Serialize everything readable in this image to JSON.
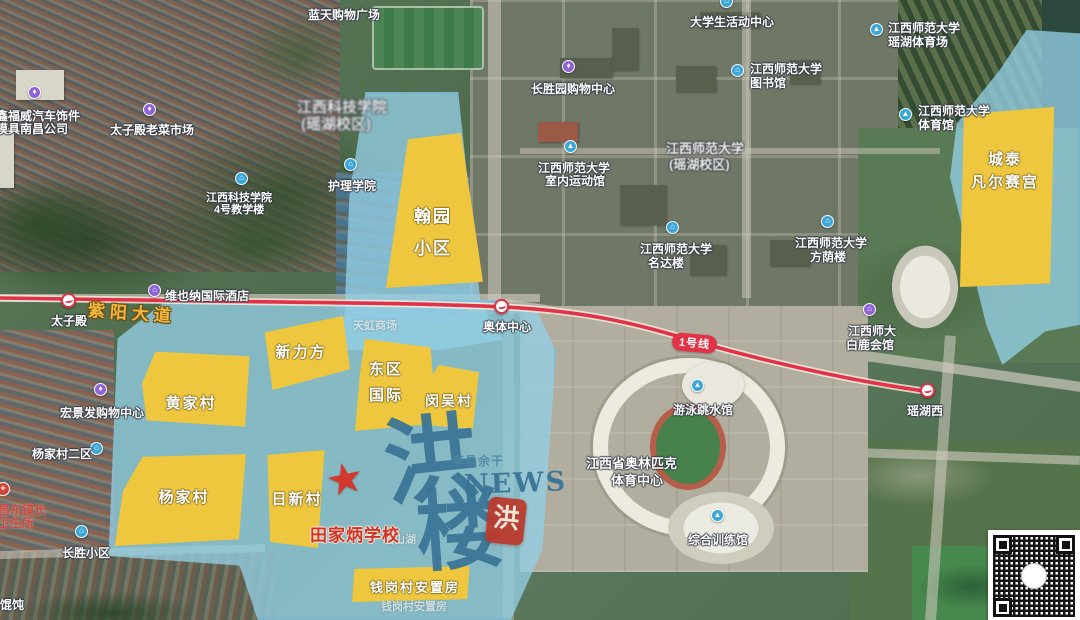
{
  "map": {
    "road_name": "紫阳大道"
  },
  "metro": {
    "line_badge": "1号线",
    "line_color": "#e23248",
    "stations": [
      {
        "id": "taizidian",
        "label": "太子殿"
      },
      {
        "id": "aoti",
        "label": "奥体中心"
      },
      {
        "id": "yaohuxi",
        "label": "瑶湖西"
      }
    ]
  },
  "zones": [
    {
      "id": "hanyuan",
      "lines": [
        "翰园",
        "小区"
      ]
    },
    {
      "id": "xinlifang",
      "lines": [
        "新力方"
      ]
    },
    {
      "id": "dongqu",
      "lines": [
        "东区",
        "国际"
      ]
    },
    {
      "id": "minwu",
      "lines": [
        "闵吴村"
      ]
    },
    {
      "id": "huangjia",
      "lines": [
        "黄家村"
      ]
    },
    {
      "id": "yangjia",
      "lines": [
        "杨家村"
      ]
    },
    {
      "id": "rixin",
      "lines": [
        "日新村"
      ]
    },
    {
      "id": "chengtai",
      "lines": [
        "城泰",
        "凡尔赛宫"
      ]
    },
    {
      "id": "qiangang",
      "lines": [
        "钱岗村安置房"
      ]
    }
  ],
  "pois": [
    {
      "id": "lantian",
      "lines": [
        "蓝天购物广场"
      ],
      "icon": null
    },
    {
      "id": "daxuesheng",
      "lines": [
        "大学生活动中心"
      ],
      "icon": "activity-center-icon",
      "icon_color": "#3ba6d8",
      "glyph": "⌂"
    },
    {
      "id": "yaohu_tiyuchang",
      "lines": [
        "江西师范大学",
        "瑶湖体育场"
      ],
      "icon": "stadium-icon",
      "icon_color": "#3ba6d8",
      "glyph": "▲"
    },
    {
      "id": "tushuguan",
      "lines": [
        "江西师范大学",
        "图书馆"
      ],
      "icon": "library-icon",
      "icon_color": "#3ba6d8",
      "glyph": "⌂"
    },
    {
      "id": "shifan_tiyuguan",
      "lines": [
        "江西师范大学",
        "体育馆"
      ],
      "icon": "gym-icon",
      "icon_color": "#3ba6d8",
      "glyph": "▲"
    },
    {
      "id": "keji_campus",
      "lines": [
        "江西科技学院",
        "(瑶湖校区)"
      ],
      "icon": null
    },
    {
      "id": "shifan_campus",
      "lines": [
        "江西师范大学",
        "(瑶湖校区)"
      ],
      "icon": null
    },
    {
      "id": "changshengyuan",
      "lines": [
        "长胜园购物中心"
      ],
      "icon": "shopping-icon",
      "icon_color": "#8f62d8",
      "glyph": "♦"
    },
    {
      "id": "shinei",
      "lines": [
        "江西师范大学",
        "室内运动馆"
      ],
      "icon": "gym-icon",
      "icon_color": "#3ba6d8",
      "glyph": "▲"
    },
    {
      "id": "huli",
      "lines": [
        "护理学院"
      ],
      "icon": "school-icon",
      "icon_color": "#3ba6d8",
      "glyph": "⌂"
    },
    {
      "id": "keji4",
      "lines": [
        "江西科技学院",
        "4号教学楼"
      ],
      "icon": "school-icon",
      "icon_color": "#3ba6d8",
      "glyph": "⌂"
    },
    {
      "id": "weiyena",
      "lines": [
        "维也纳国际酒店"
      ],
      "icon": "hotel-icon",
      "icon_color": "#8f62d8",
      "glyph": "⌂"
    },
    {
      "id": "taizimarket",
      "lines": [
        "太子殿老菜市场"
      ],
      "icon": "market-icon",
      "icon_color": "#8f62d8",
      "glyph": "♦"
    },
    {
      "id": "xinfuwei",
      "lines": [
        "鑫福威汽车饰件",
        "模具南昌公司"
      ],
      "icon": "shop-icon",
      "icon_color": "#8f62d8",
      "glyph": "♦"
    },
    {
      "id": "hongjingfa",
      "lines": [
        "宏景发购物中心"
      ],
      "icon": "shopping-icon",
      "icon_color": "#8f62d8",
      "glyph": "♦"
    },
    {
      "id": "yangjia2",
      "lines": [
        "杨家村二区"
      ],
      "icon": "residence-icon",
      "icon_color": "#3ba6d8",
      "glyph": "⌂"
    },
    {
      "id": "changshengxq",
      "lines": [
        "长胜小区"
      ],
      "icon": "residence-icon",
      "icon_color": "#3ba6d8",
      "glyph": "⌂"
    },
    {
      "id": "mingdalou",
      "lines": [
        "江西师范大学",
        "名达楼"
      ],
      "icon": "building-icon",
      "icon_color": "#3ba6d8",
      "glyph": "⌂"
    },
    {
      "id": "fangyinlou",
      "lines": [
        "江西师范大学",
        "方荫楼"
      ],
      "icon": "building-icon",
      "icon_color": "#3ba6d8",
      "glyph": "⌂"
    },
    {
      "id": "bailu",
      "lines": [
        "江西师大",
        "白鹿会馆"
      ],
      "icon": "hotel-icon",
      "icon_color": "#8f62d8",
      "glyph": "⌂"
    },
    {
      "id": "youyong",
      "lines": [
        "游泳跳水馆"
      ],
      "icon": "swim-icon",
      "icon_color": "#3ba6d8",
      "glyph": "▲"
    },
    {
      "id": "aolinpike",
      "lines": [
        "江西省奥林匹克",
        "体育中心"
      ],
      "icon": null
    },
    {
      "id": "zonghe",
      "lines": [
        "综合训练馆"
      ],
      "icon": "gym-icon",
      "icon_color": "#3ba6d8",
      "glyph": "▲"
    }
  ],
  "faint_labels": [
    {
      "id": "tianhong",
      "text": "天虹商场"
    },
    {
      "id": "yaoshanhu",
      "text": "瑶山湖"
    },
    {
      "id": "qiangang_faint",
      "text": "钱岗村安置房"
    }
  ],
  "annotations": {
    "school_label": "田家炳学校",
    "health_center_lines": [
      "昌东镇长",
      "卫生所"
    ],
    "wonton_label": "味馄饨",
    "star_color": "#d2382c"
  },
  "watermark": {
    "char_top": "洪",
    "char_bottom": "楼",
    "latin": "NEWS",
    "subtitle": "南昌余干",
    "seal_char": "洪",
    "color": "#3a7495",
    "seal_color": "#bb3b2e"
  },
  "colors": {
    "zone_yellow": "#eec73e",
    "overlay_blue": "rgba(148,206,228,0.78)",
    "metro_red": "#e23248"
  }
}
